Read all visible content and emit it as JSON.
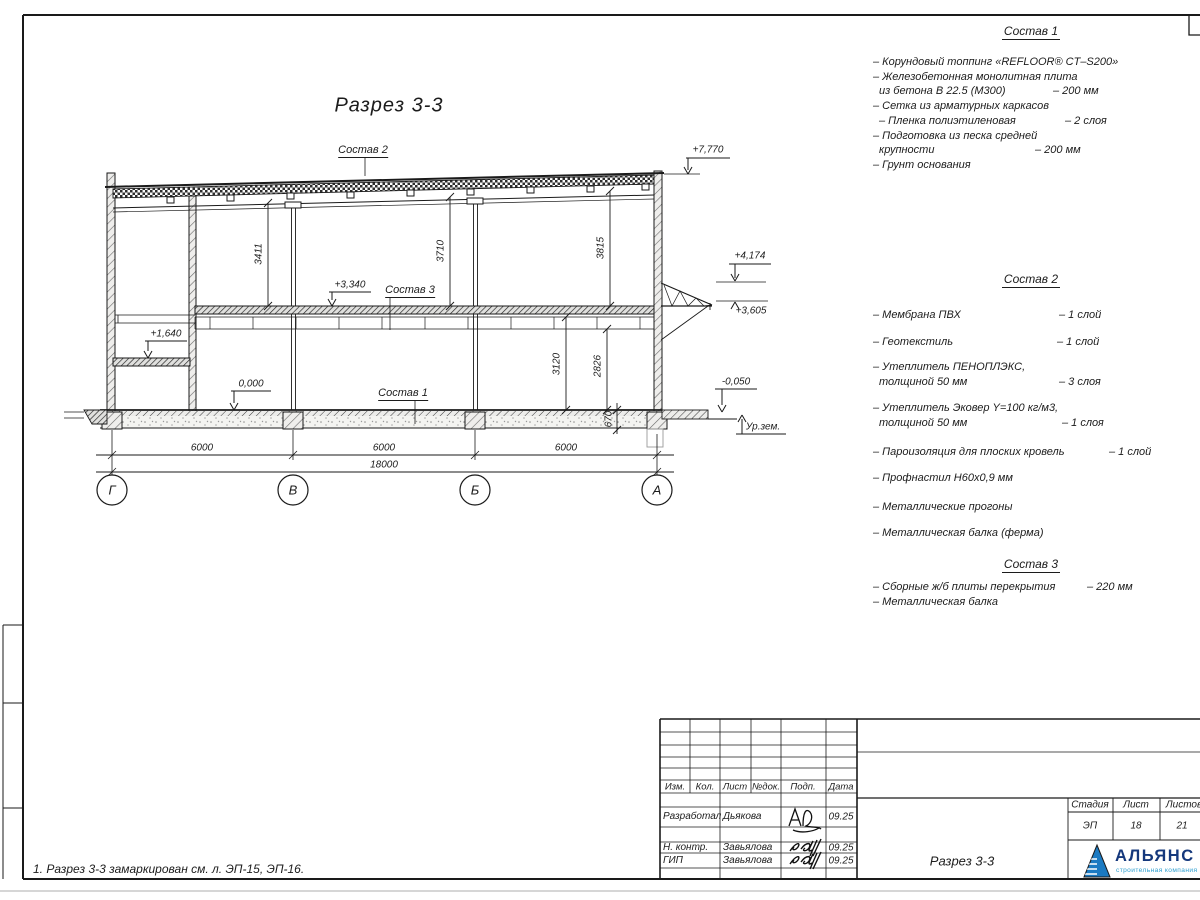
{
  "sheet": {
    "view_title": "Разрез 3-3",
    "note": "1. Разрез 3-3 замаркирован см. л. ЭП-15, ЭП-16."
  },
  "labels": {
    "sostav1": "Состав 1",
    "sostav2": "Состав 2",
    "sostav3": "Состав 3"
  },
  "levels": {
    "l7770": "+7,770",
    "l4174": "+4,174",
    "l3605": "+3,605",
    "l3340": "+3,340",
    "l1640": "+1,640",
    "l0000": "0,000",
    "lm050": "-0,050",
    "ground": "Ур.зем."
  },
  "dims": {
    "v3411": "3411",
    "v3710": "3710",
    "v3815": "3815",
    "v3120": "3120",
    "v2826": "2826",
    "v670": "670",
    "s1": "6000",
    "s2": "6000",
    "s3": "6000",
    "total": "18000"
  },
  "axes": [
    "Г",
    "В",
    "Б",
    "А"
  ],
  "compositions": {
    "c1": {
      "heading": "Состав 1",
      "rows": [
        {
          "t": "– Корундовый топпинг «REFLOOR® CT–S200»"
        },
        {
          "t": "– Железобетонная  монолитная плита"
        },
        {
          "t": "из бетона В 22.5 (М300)",
          "v": "– 200 мм"
        },
        {
          "t": "– Сетка из арматурных каркасов"
        },
        {
          "t": "– Пленка полиэтиленовая",
          "v": "– 2 слоя"
        },
        {
          "t": "– Подготовка из песка средней"
        },
        {
          "t": "крупности",
          "v": "– 200 мм"
        },
        {
          "t": "– Грунт основания"
        }
      ]
    },
    "c2": {
      "heading": "Состав 2",
      "rows": [
        {
          "t": "– Мембрана ПВХ",
          "v": "– 1 слой"
        },
        {
          "t": "– Геотекстиль",
          "v": "– 1 слой"
        },
        {
          "t": "– Утеплитель ПЕНОПЛЭКС,"
        },
        {
          "t": "толщиной 50 мм",
          "v": "– 3 слоя"
        },
        {
          "t": "– Утеплитель Эковер Y=100 кг/м3,"
        },
        {
          "t": "толщиной 50 мм",
          "v": "– 1 слоя"
        },
        {
          "t": "– Пароизоляция для плоских кровель",
          "v": "– 1 слой"
        },
        {
          "t": "– Профнастил Н60х0,9 мм"
        },
        {
          "t": "– Металлические прогоны"
        },
        {
          "t": "– Металлическая балка (ферма)"
        }
      ]
    },
    "c3": {
      "heading": "Состав 3",
      "rows": [
        {
          "t": "– Сборные ж/б плиты перекрытия",
          "v": "– 220 мм"
        },
        {
          "t": "– Металлическая балка"
        }
      ]
    }
  },
  "titleblock": {
    "header": [
      "Изм.",
      "Кол.",
      "Лист",
      "№док.",
      "Подп.",
      "Дата"
    ],
    "rows": [
      {
        "role": "Разработал",
        "name": "Дьякова",
        "date": "09.25"
      },
      {
        "role": "Н. контр.",
        "name": "Завьялова",
        "date": "09.25"
      },
      {
        "role": "ГИП",
        "name": "Завьялова",
        "date": "09.25"
      }
    ],
    "doc_title": "Разрез 3-3",
    "stage_label": "Стадия",
    "sheet_label": "Лист",
    "sheets_label": "Листов",
    "stage": "ЭП",
    "sheet": "18",
    "sheets": "21",
    "logo": {
      "name": "АЛЬЯНС",
      "tagline": "строительная компания"
    }
  }
}
